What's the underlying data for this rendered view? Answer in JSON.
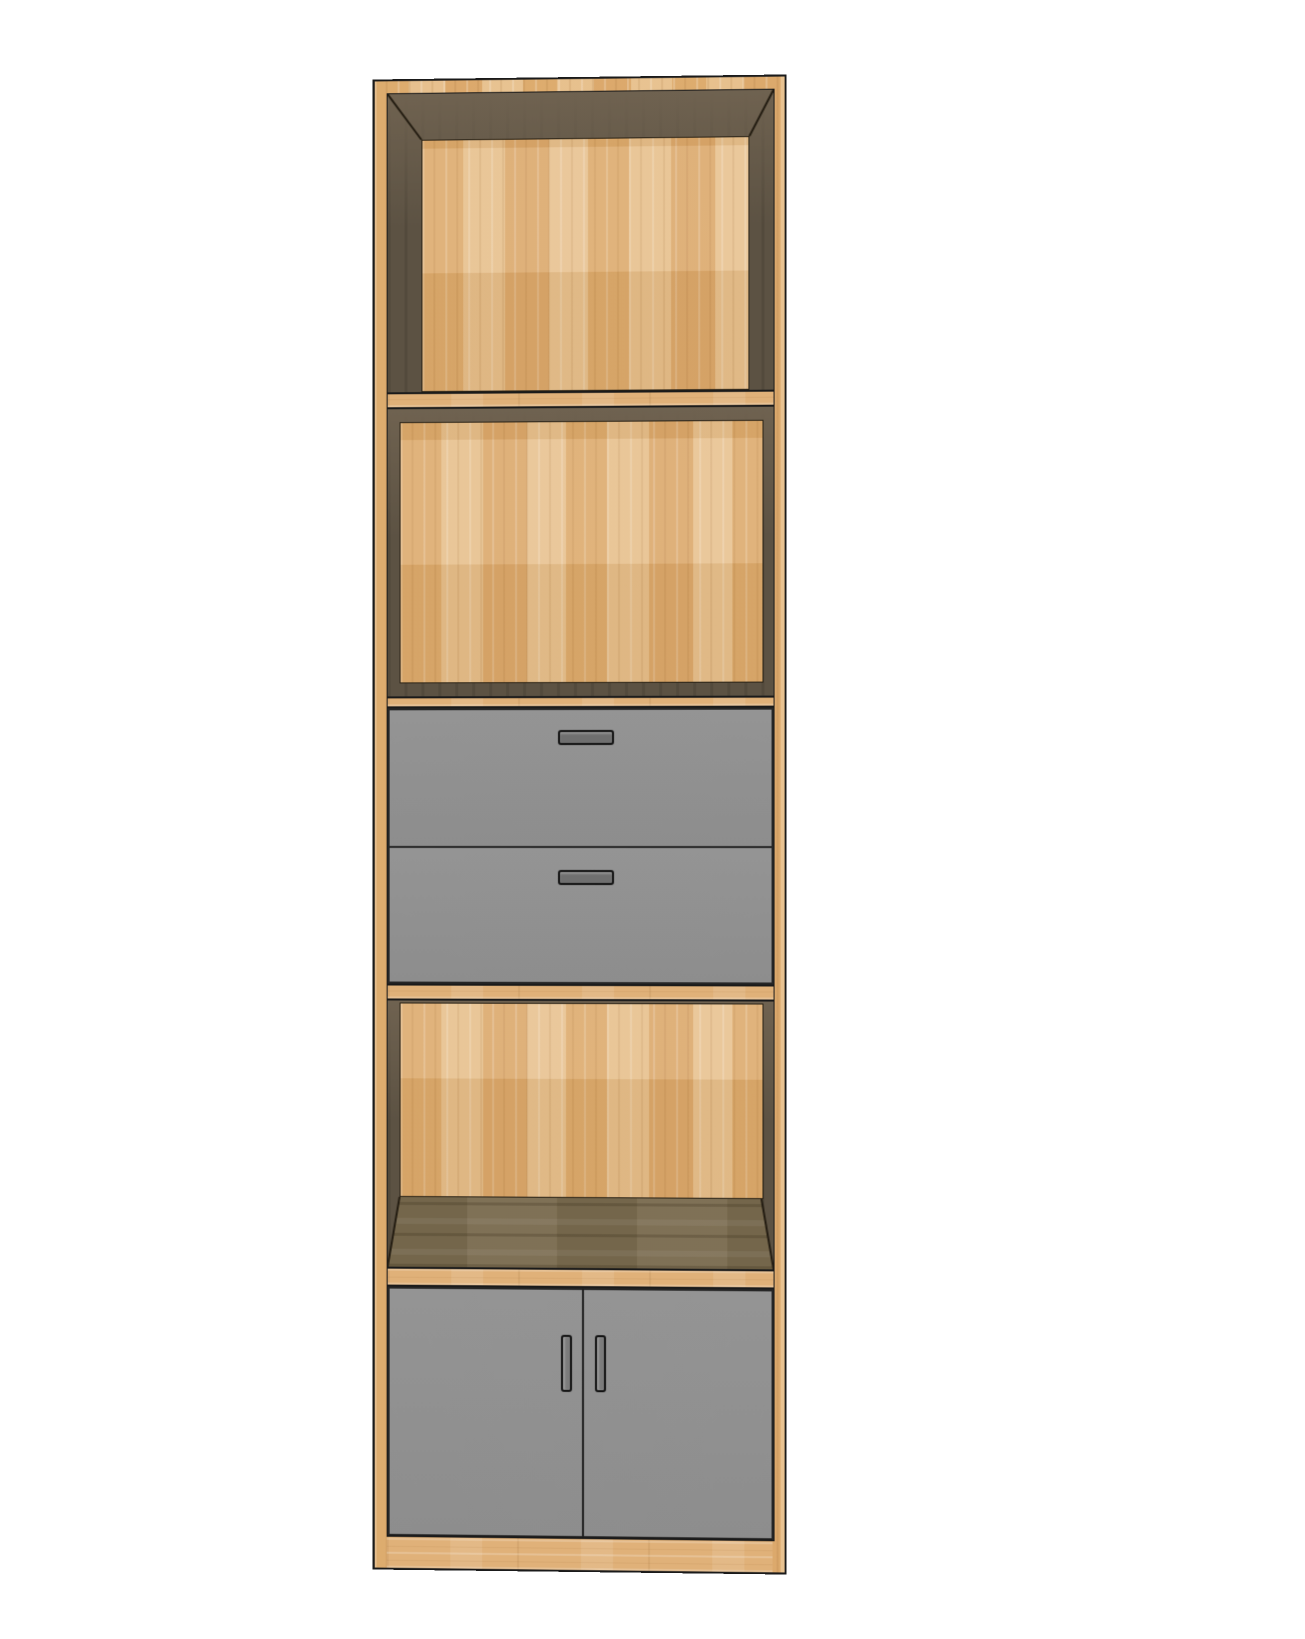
{
  "scene": {
    "type": "3d-furniture-render",
    "object": "tall storage cabinet tower",
    "view": "front elevation with slight perspective; interior faces shadowed dark brown",
    "background_color": "#FFFFFF"
  },
  "cabinet": {
    "frame_material": "light butcher-block wood",
    "interior_shadow_material": "dark walnut wood",
    "front_panel_material": "flat gray painted panels",
    "sections_top_to_bottom": [
      {
        "id": "open-compartment-1",
        "type": "open-compartment",
        "back": "light wood panel"
      },
      {
        "id": "shelf-1",
        "type": "fixed-shelf"
      },
      {
        "id": "open-compartment-2",
        "type": "open-compartment",
        "back": "light wood panel"
      },
      {
        "id": "shelf-2",
        "type": "fixed-shelf"
      },
      {
        "id": "drawer-1",
        "type": "drawer",
        "handle": "horizontal-bar-handle"
      },
      {
        "id": "drawer-2",
        "type": "drawer",
        "handle": "horizontal-bar-handle"
      },
      {
        "id": "shelf-3",
        "type": "fixed-shelf"
      },
      {
        "id": "open-compartment-3",
        "type": "open-compartment",
        "back": "light wood panel",
        "bottom": "dark wood shelf surface visible"
      },
      {
        "id": "shelf-4",
        "type": "fixed-shelf"
      },
      {
        "id": "door-cabinet",
        "type": "double-door-cabinet",
        "handles": "two vertical-bar-handles at center split"
      }
    ],
    "counts": {
      "open_compartments": 3,
      "drawers": 2,
      "doors": 2,
      "fixed_shelves": 4
    }
  },
  "colors": {
    "background": "#FFFFFF",
    "wood_light": "#E0B179",
    "wood_light_hi": "#EECDA0",
    "wood_light_lo": "#D5A263",
    "wood_dark": "#5C5243",
    "wood_dark_hi": "#6F6250",
    "wood_floor": "#7A6B4F",
    "panel_gray": "#8D8D8D",
    "panel_gray_hi": "#949494",
    "handle_drawer": "#6F6F6F",
    "handle_door": "#7B7B7B",
    "outline": "#1A1A1A",
    "seam": "#2A2215"
  }
}
